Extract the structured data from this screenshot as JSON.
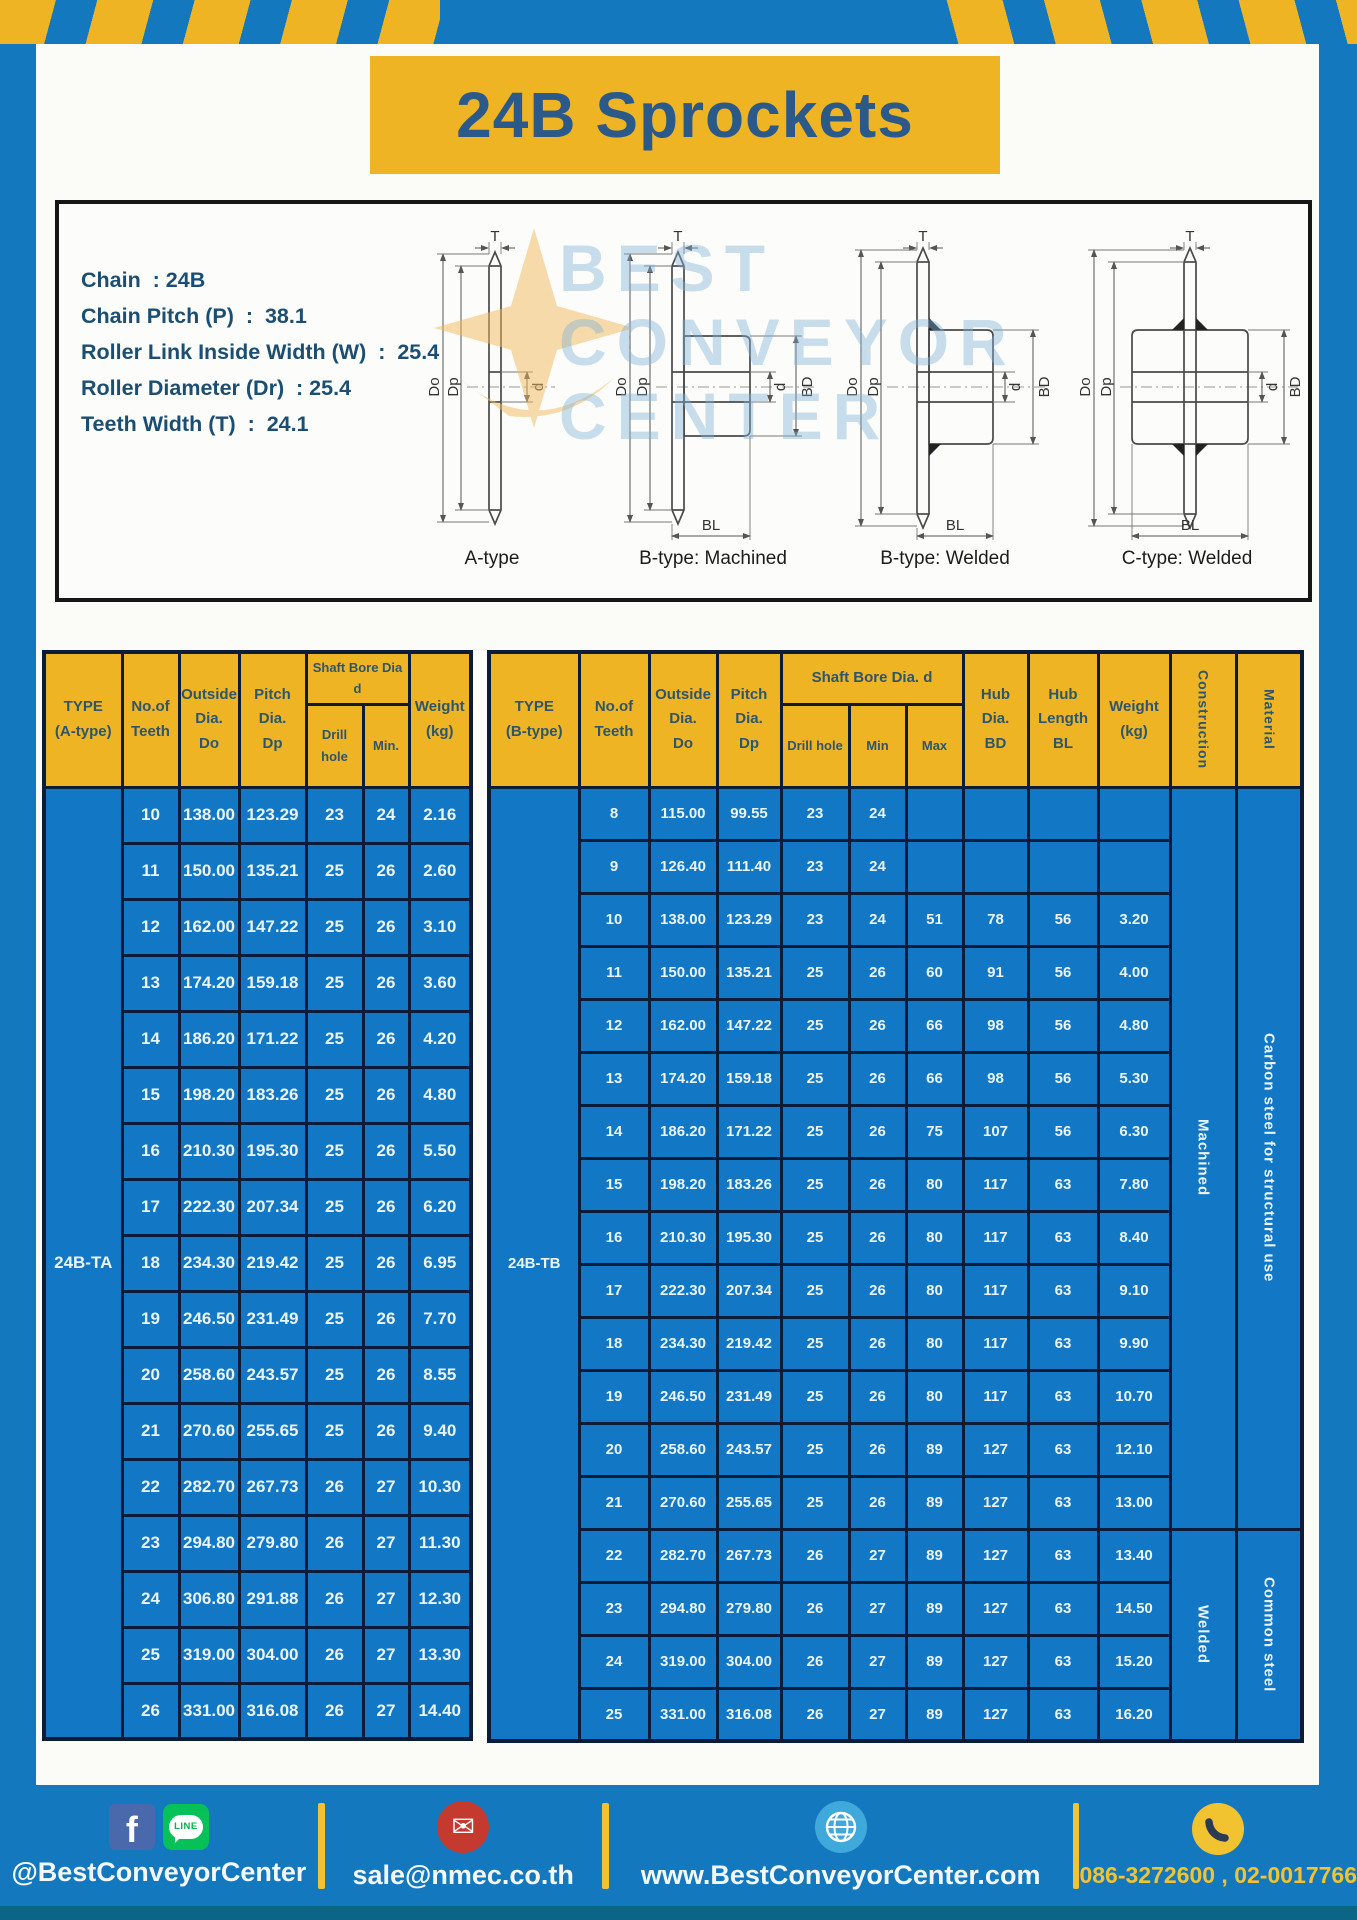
{
  "title": "24B Sprockets",
  "specs": [
    "Chain  : 24B",
    "Chain Pitch (P)  :  38.1",
    "Roller Link Inside Width (W)  :  25.4",
    "Roller Diameter (Dr)  : 25.4",
    "Teeth Width (T)  :  24.1"
  ],
  "watermark": "BEST\nCONVEYOR\nCENTER",
  "diagram": {
    "dim_labels": {
      "t": "T",
      "do": "Do",
      "dp": "Dp",
      "d": "d",
      "bd": "BD",
      "bl": "BL"
    },
    "captions": [
      "A-type",
      "B-type: Machined",
      "B-type: Welded",
      "C-type: Welded"
    ]
  },
  "table_a": {
    "type_label": "24B-TA",
    "headers": {
      "type": "TYPE\n(A-type)",
      "teeth": "No.of\nTeeth",
      "outside": "Outside\nDia.\nDo",
      "pitch": "Pitch Dia.\nDp",
      "shaft_group": "Shaft Bore Dia d",
      "drill": "Drill hole",
      "min": "Min.",
      "weight": "Weight\n(kg)"
    },
    "rows": [
      [
        "10",
        "138.00",
        "123.29",
        "23",
        "24",
        "2.16"
      ],
      [
        "11",
        "150.00",
        "135.21",
        "25",
        "26",
        "2.60"
      ],
      [
        "12",
        "162.00",
        "147.22",
        "25",
        "26",
        "3.10"
      ],
      [
        "13",
        "174.20",
        "159.18",
        "25",
        "26",
        "3.60"
      ],
      [
        "14",
        "186.20",
        "171.22",
        "25",
        "26",
        "4.20"
      ],
      [
        "15",
        "198.20",
        "183.26",
        "25",
        "26",
        "4.80"
      ],
      [
        "16",
        "210.30",
        "195.30",
        "25",
        "26",
        "5.50"
      ],
      [
        "17",
        "222.30",
        "207.34",
        "25",
        "26",
        "6.20"
      ],
      [
        "18",
        "234.30",
        "219.42",
        "25",
        "26",
        "6.95"
      ],
      [
        "19",
        "246.50",
        "231.49",
        "25",
        "26",
        "7.70"
      ],
      [
        "20",
        "258.60",
        "243.57",
        "25",
        "26",
        "8.55"
      ],
      [
        "21",
        "270.60",
        "255.65",
        "25",
        "26",
        "9.40"
      ],
      [
        "22",
        "282.70",
        "267.73",
        "26",
        "27",
        "10.30"
      ],
      [
        "23",
        "294.80",
        "279.80",
        "26",
        "27",
        "11.30"
      ],
      [
        "24",
        "306.80",
        "291.88",
        "26",
        "27",
        "12.30"
      ],
      [
        "25",
        "319.00",
        "304.00",
        "26",
        "27",
        "13.30"
      ],
      [
        "26",
        "331.00",
        "316.08",
        "26",
        "27",
        "14.40"
      ]
    ]
  },
  "table_b": {
    "type_label": "24B-TB",
    "headers": {
      "type": "TYPE\n(B-type)",
      "teeth": "No.of\nTeeth",
      "outside": "Outside\nDia.\nDo",
      "pitch": "Pitch\nDia.\nDp",
      "shaft_group": "Shaft Bore Dia.  d",
      "drill": "Drill hole",
      "min": "Min",
      "max": "Max",
      "hub_dia": "Hub\nDia.\nBD",
      "hub_len": "Hub\nLength\nBL",
      "weight": "Weight\n(kg)",
      "construction": "Construction",
      "material": "Material"
    },
    "rows": [
      [
        "8",
        "115.00",
        "99.55",
        "23",
        "24",
        "",
        "",
        "",
        ""
      ],
      [
        "9",
        "126.40",
        "111.40",
        "23",
        "24",
        "",
        "",
        "",
        ""
      ],
      [
        "10",
        "138.00",
        "123.29",
        "23",
        "24",
        "51",
        "78",
        "56",
        "3.20"
      ],
      [
        "11",
        "150.00",
        "135.21",
        "25",
        "26",
        "60",
        "91",
        "56",
        "4.00"
      ],
      [
        "12",
        "162.00",
        "147.22",
        "25",
        "26",
        "66",
        "98",
        "56",
        "4.80"
      ],
      [
        "13",
        "174.20",
        "159.18",
        "25",
        "26",
        "66",
        "98",
        "56",
        "5.30"
      ],
      [
        "14",
        "186.20",
        "171.22",
        "25",
        "26",
        "75",
        "107",
        "56",
        "6.30"
      ],
      [
        "15",
        "198.20",
        "183.26",
        "25",
        "26",
        "80",
        "117",
        "63",
        "7.80"
      ],
      [
        "16",
        "210.30",
        "195.30",
        "25",
        "26",
        "80",
        "117",
        "63",
        "8.40"
      ],
      [
        "17",
        "222.30",
        "207.34",
        "25",
        "26",
        "80",
        "117",
        "63",
        "9.10"
      ],
      [
        "18",
        "234.30",
        "219.42",
        "25",
        "26",
        "80",
        "117",
        "63",
        "9.90"
      ],
      [
        "19",
        "246.50",
        "231.49",
        "25",
        "26",
        "80",
        "117",
        "63",
        "10.70"
      ],
      [
        "20",
        "258.60",
        "243.57",
        "25",
        "26",
        "89",
        "127",
        "63",
        "12.10"
      ],
      [
        "21",
        "270.60",
        "255.65",
        "25",
        "26",
        "89",
        "127",
        "63",
        "13.00"
      ],
      [
        "22",
        "282.70",
        "267.73",
        "26",
        "27",
        "89",
        "127",
        "63",
        "13.40"
      ],
      [
        "23",
        "294.80",
        "279.80",
        "26",
        "27",
        "89",
        "127",
        "63",
        "14.50"
      ],
      [
        "24",
        "319.00",
        "304.00",
        "26",
        "27",
        "89",
        "127",
        "63",
        "15.20"
      ],
      [
        "25",
        "331.00",
        "316.08",
        "26",
        "27",
        "89",
        "127",
        "63",
        "16.20"
      ]
    ],
    "construction_spans": [
      {
        "label": "Machined",
        "rows": 14
      },
      {
        "label": "Welded",
        "rows": 4
      }
    ],
    "material_spans": [
      {
        "label": "Carbon steel for structural use",
        "rows": 14
      },
      {
        "label": "Common steel",
        "rows": 4
      }
    ]
  },
  "footer": {
    "facebook_glyph": "f",
    "line_badge": "LINE",
    "social_text": "@BestConveyorCenter",
    "email": "sale@nmec.co.th",
    "website": "www.BestConveyorCenter.com",
    "phone": "086-3272600 , 02-0017766"
  },
  "colors": {
    "frame_blue": "#1478bf",
    "table_blue": "#1278c6",
    "gold": "#eeb424",
    "navy_title": "#2a598a",
    "header_text": "#2e566b",
    "border_dark": "#0a1c38",
    "body_text": "#e9f4fb"
  }
}
